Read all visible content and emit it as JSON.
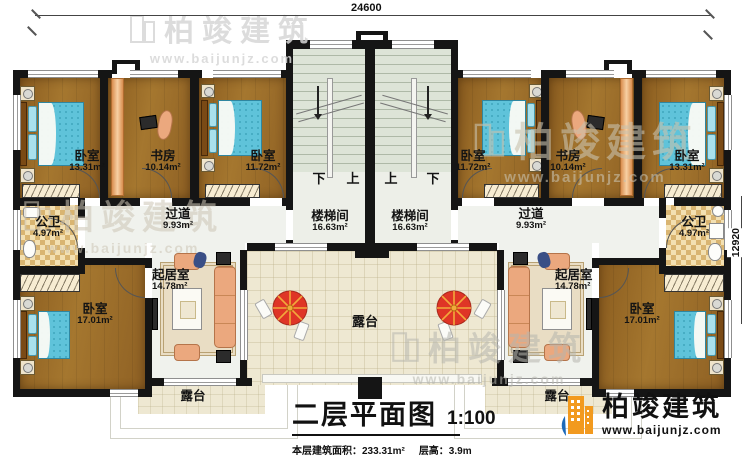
{
  "dimensions": {
    "top": "24600",
    "right": "12920"
  },
  "watermark": {
    "name": "柏竣建筑",
    "url": "www.baijunjz.com"
  },
  "logo": {
    "name": "柏竣建筑",
    "url": "www.baijunjz.com"
  },
  "title_block": {
    "title": "二层平面图",
    "scale": "1:100",
    "area_label": "本层建筑面积：233.31m²",
    "height_label": "层高：3.9m"
  },
  "stairs": {
    "left": {
      "down": "下",
      "up": "上"
    },
    "right": {
      "up": "上",
      "down": "下"
    }
  },
  "rooms": {
    "bedroom_tl": {
      "label": "卧室",
      "area": "13.31m²"
    },
    "study_l": {
      "label": "书房",
      "area": "10.14m²"
    },
    "bedroom_tl2": {
      "label": "卧室",
      "area": "11.72m²"
    },
    "bedroom_tr2": {
      "label": "卧室",
      "area": "11.72m²"
    },
    "study_r": {
      "label": "书房",
      "area": "10.14m²"
    },
    "bedroom_tr": {
      "label": "卧室",
      "area": "13.31m²"
    },
    "bath_l": {
      "label": "公卫",
      "area": "4.97m²"
    },
    "bath_r": {
      "label": "公卫",
      "area": "4.97m²"
    },
    "hall_l": {
      "label": "过道",
      "area": "9.93m²"
    },
    "hall_r": {
      "label": "过道",
      "area": "9.93m²"
    },
    "stair_l": {
      "label": "楼梯间",
      "area": "16.63m²"
    },
    "stair_r": {
      "label": "楼梯间",
      "area": "16.63m²"
    },
    "living_l": {
      "label": "起居室",
      "area": "14.78m²"
    },
    "living_r": {
      "label": "起居室",
      "area": "14.78m²"
    },
    "bedroom_bl": {
      "label": "卧室",
      "area": "17.01m²"
    },
    "bedroom_br": {
      "label": "卧室",
      "area": "17.01m²"
    },
    "terrace_c": {
      "label": "露台"
    },
    "terrace_bl": {
      "label": "露台"
    },
    "terrace_br": {
      "label": "露台"
    }
  },
  "colors": {
    "wall": "#151515",
    "wood_floor": "#9a6b28",
    "stair_floor": "#e0e6da",
    "terrace_floor": "#eee8d2",
    "bath_floor": "#f3e0b2",
    "bed": "#5fc3da",
    "sofa": "#eba87e",
    "umbrella_red": "#df3526",
    "logo_orange": "#f29a1f",
    "logo_blue": "#1c69b8"
  }
}
